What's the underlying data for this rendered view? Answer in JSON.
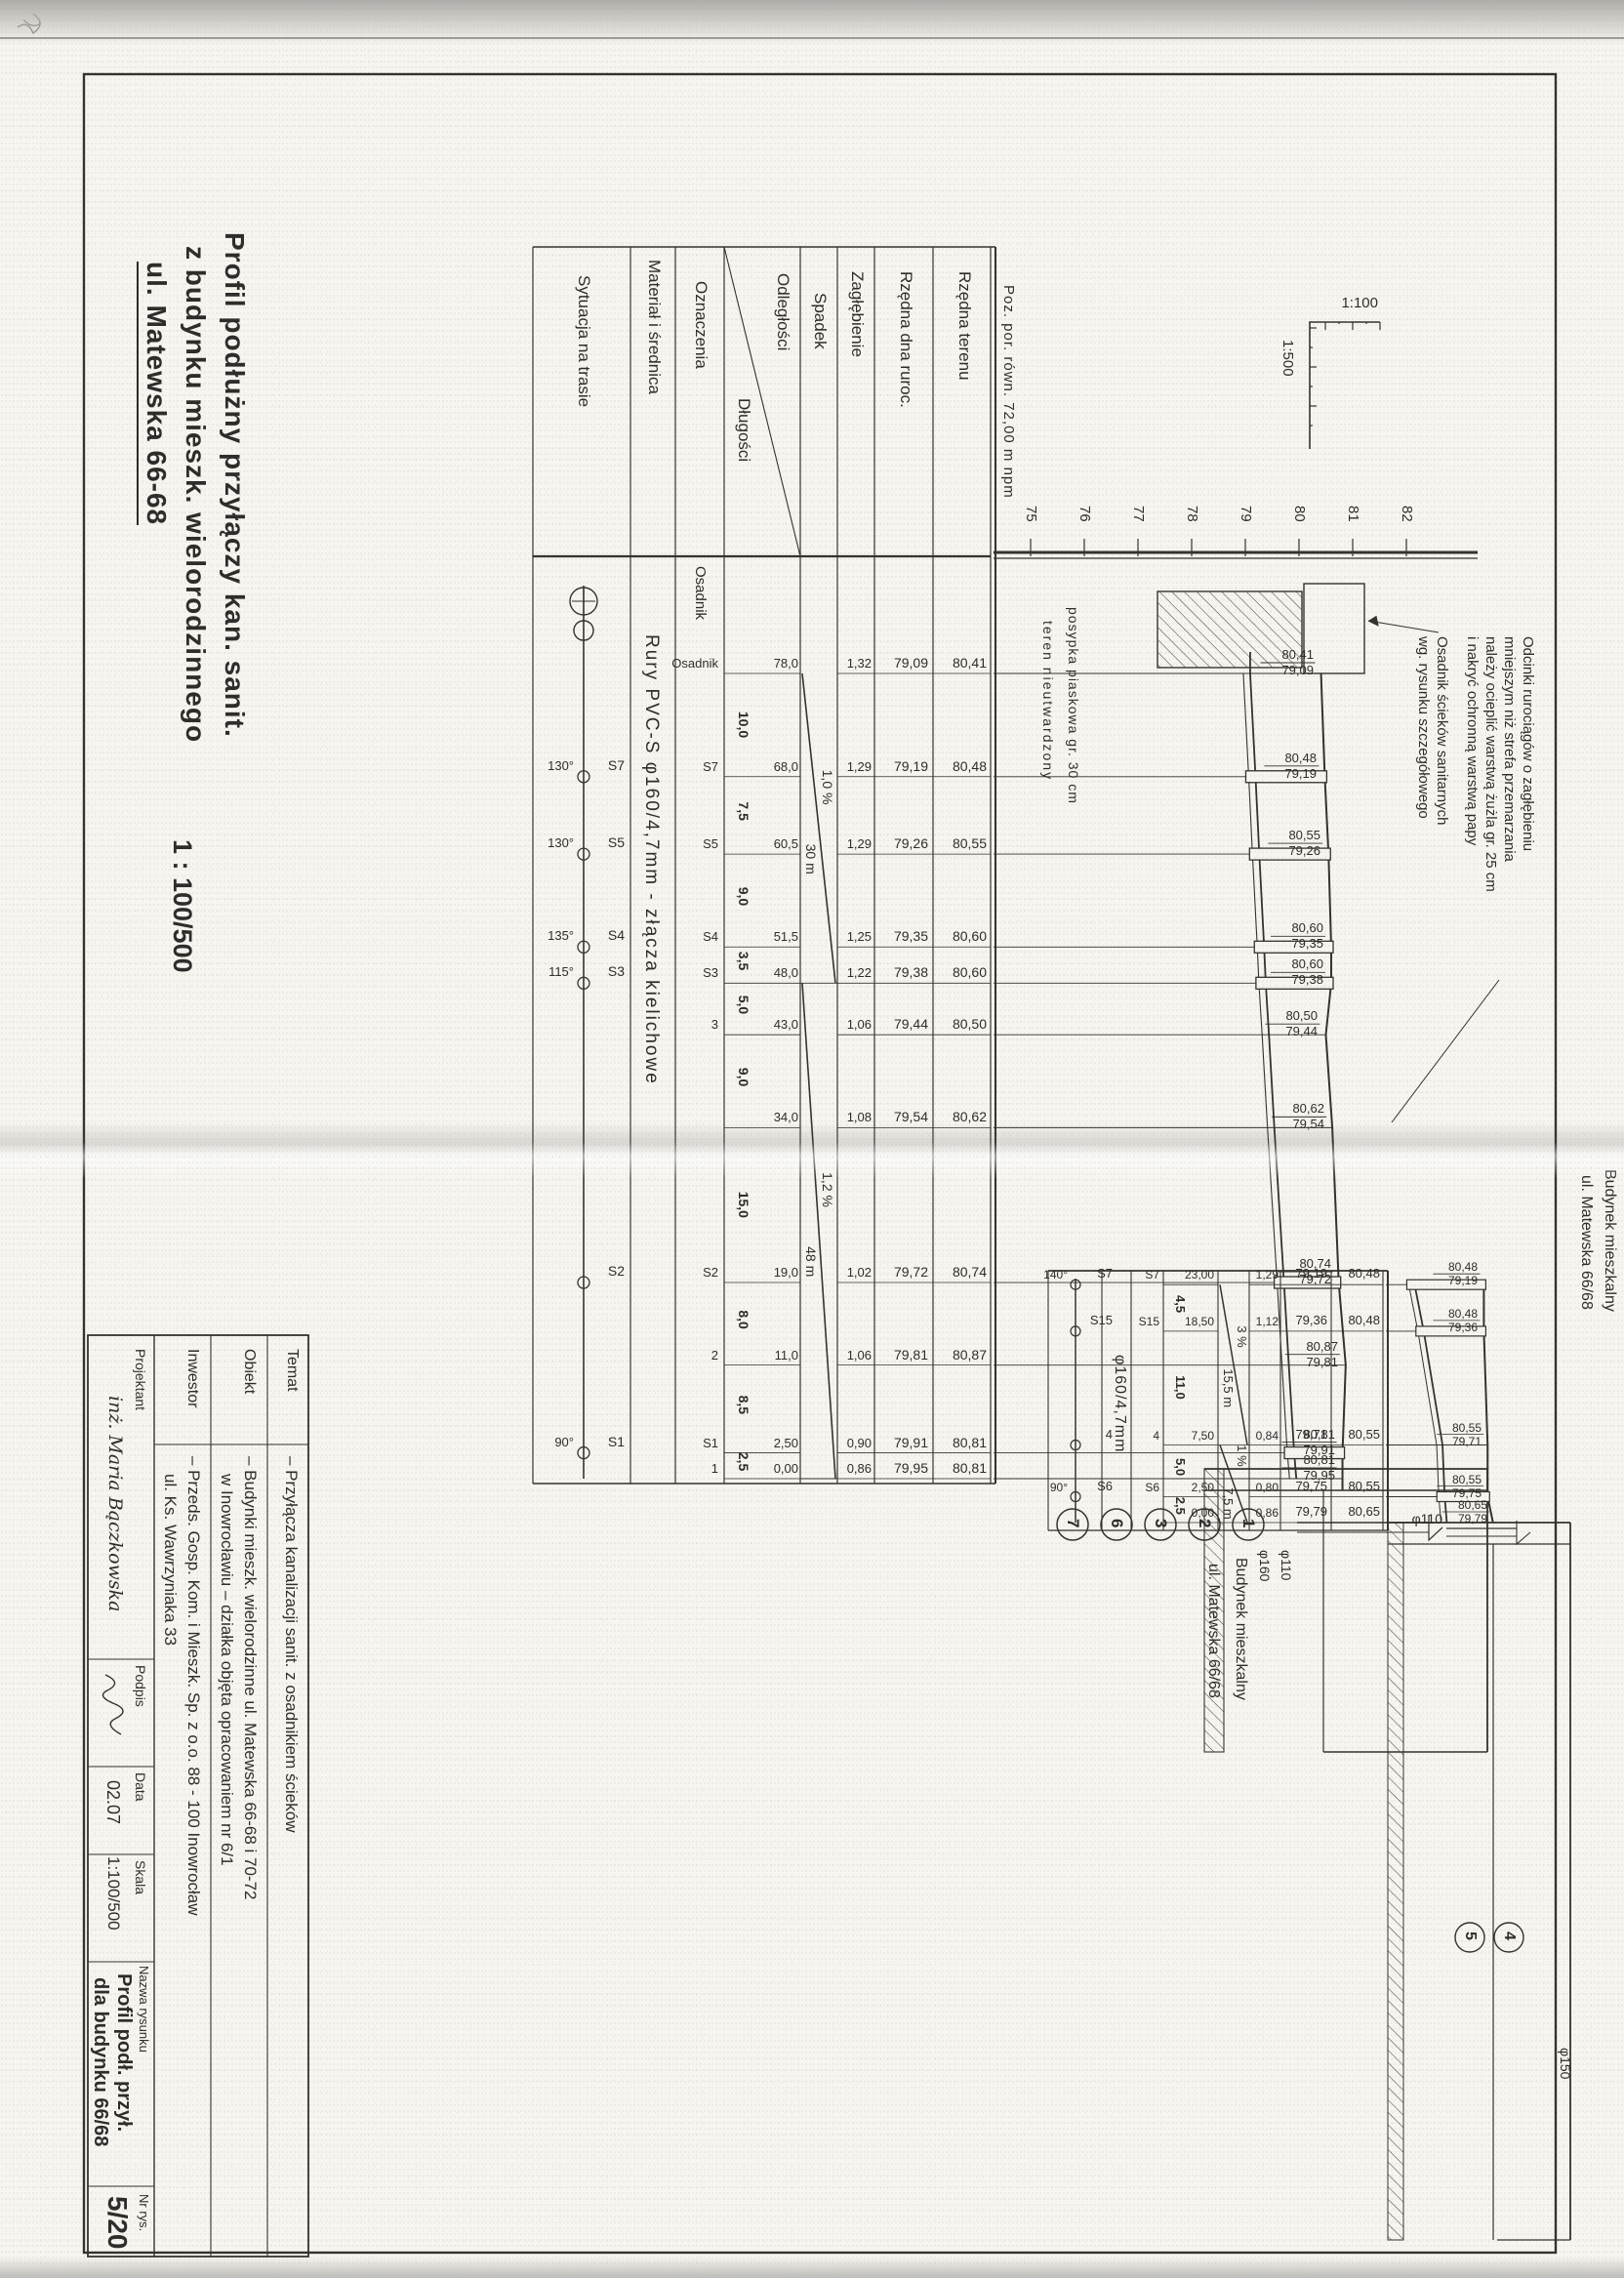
{
  "title": {
    "line1": "Profil podłużny przyłączy kan. sanit.",
    "line2": "z budynku mieszk. wielorodzinnego",
    "line3": "ul. Matewska 66-68",
    "scale": "1 : 100/500"
  },
  "scale_indicator": {
    "vertical": "1:100",
    "horizontal": "1:500"
  },
  "datum_label": "Poz. por. równ. 72,00 m npm",
  "axis_elevations": [
    "75",
    "76",
    "77",
    "78",
    "79",
    "80",
    "81",
    "82"
  ],
  "row_headers": {
    "rzedna_terenu": "Rzędna terenu",
    "rzedna_dna": "Rzędna dna ruroc.",
    "zaglebienie": "Zagłębienie",
    "spadek": "Spadek",
    "odleglosci": "Odległości",
    "dlugosci": "Długości",
    "oznaczenia": "Oznaczenia",
    "material": "Materiał i średnica",
    "sytuacja": "Sytuacja na trasie"
  },
  "notes": {
    "insulation": [
      "Odcinki rurociągów o zagłębieniu",
      "mniejszym niż strefa przemarzania",
      "należy ocieplić warstwą żużla gr. 25 cm",
      "i nakryć ochronną warstwą papy"
    ],
    "osadnik": [
      "Osadnik ścieków sanitarnych",
      "wg. rysunku szczegółowego"
    ]
  },
  "ground_notes": [
    "posypka piaskowa gr. 30 cm",
    "teren nieutwardzony"
  ],
  "upper": {
    "material": "Rury PVC-S  φ160/4,7mm - złącza kielichowe",
    "stations": [
      {
        "ch": "78,0",
        "chv": 78.0,
        "ter": "80,41",
        "terv": 80.41,
        "dna": "79,09",
        "dnav": 79.09,
        "zag": "1,32",
        "ozn": "Osadnik"
      },
      {
        "ch": "68,0",
        "chv": 68.0,
        "ter": "80,48",
        "terv": 80.48,
        "dna": "79,19",
        "dnav": 79.19,
        "zag": "1,29",
        "ozn": "S7"
      },
      {
        "ch": "60,5",
        "chv": 60.5,
        "ter": "80,55",
        "terv": 80.55,
        "dna": "79,26",
        "dnav": 79.26,
        "zag": "1,29",
        "ozn": "S5"
      },
      {
        "ch": "51,5",
        "chv": 51.5,
        "ter": "80,60",
        "terv": 80.6,
        "dna": "79,35",
        "dnav": 79.35,
        "zag": "1,25",
        "ozn": "S4"
      },
      {
        "ch": "48,0",
        "chv": 48.0,
        "ter": "80,60",
        "terv": 80.6,
        "dna": "79,38",
        "dnav": 79.38,
        "zag": "1,22",
        "ozn": "S3"
      },
      {
        "ch": "43,0",
        "chv": 43.0,
        "ter": "80,50",
        "terv": 80.5,
        "dna": "79,44",
        "dnav": 79.44,
        "zag": "1,06",
        "ozn": "3"
      },
      {
        "ch": "34,0",
        "chv": 34.0,
        "ter": "80,62",
        "terv": 80.62,
        "dna": "79,54",
        "dnav": 79.54,
        "zag": "1,08",
        "ozn": ""
      },
      {
        "ch": "19,0",
        "chv": 19.0,
        "ter": "80,74",
        "terv": 80.74,
        "dna": "79,72",
        "dnav": 79.72,
        "zag": "1,02",
        "ozn": "S2"
      },
      {
        "ch": "11,0",
        "chv": 11.0,
        "ter": "80,87",
        "terv": 80.87,
        "dna": "79,81",
        "dnav": 79.81,
        "zag": "1,06",
        "ozn": "2"
      },
      {
        "ch": "2,50",
        "chv": 2.5,
        "ter": "80,81",
        "terv": 80.81,
        "dna": "79,91",
        "dnav": 79.91,
        "zag": "0,90",
        "ozn": "S1"
      },
      {
        "ch": "0,00",
        "chv": 0.0,
        "ter": "80,81",
        "terv": 80.81,
        "dna": "79,95",
        "dnav": 79.95,
        "zag": "0,86",
        "ozn": "1"
      }
    ],
    "lengths": [
      "10,0",
      "7,5",
      "9,0",
      "3,5",
      "5,0",
      "9,0",
      "15,0",
      "8,0",
      "8,5",
      "2,5"
    ],
    "slopes": [
      {
        "label": "1,0 %",
        "length": "30 m",
        "from": 78.0,
        "to": 48.0
      },
      {
        "label": "1,2 %",
        "length": "48 m",
        "from": 48.0,
        "to": 0.0
      }
    ],
    "situation": [
      {
        "name": "S7",
        "angle": "130°",
        "chv": 68.0
      },
      {
        "name": "S5",
        "angle": "130°",
        "chv": 60.5
      },
      {
        "name": "S4",
        "angle": "135°",
        "chv": 51.5
      },
      {
        "name": "S3",
        "angle": "115°",
        "chv": 48.0
      },
      {
        "name": "S2",
        "angle": "",
        "chv": 19.0
      },
      {
        "name": "S1",
        "angle": "90°",
        "chv": 2.5
      }
    ],
    "building": {
      "line1": "Budynek mieszkalny",
      "line2": "ul. Matewska 66/68"
    },
    "callouts": [
      "1",
      "2",
      "3",
      "6",
      "7"
    ],
    "pipe_labels": [
      "φ110",
      "φ160"
    ]
  },
  "lower": {
    "material": "φ160/4,7mm",
    "stations": [
      {
        "ch": "23,00",
        "chv": 23.0,
        "ter": "80,48",
        "terv": 80.48,
        "dna": "79,19",
        "dnav": 79.19,
        "zag": "1,29",
        "ozn": "S7"
      },
      {
        "ch": "18,50",
        "chv": 18.5,
        "ter": "80,48",
        "terv": 80.48,
        "dna": "79,36",
        "dnav": 79.36,
        "zag": "1,12",
        "ozn": "S15"
      },
      {
        "ch": "7,50",
        "chv": 7.5,
        "ter": "80,55",
        "terv": 80.55,
        "dna": "79,71",
        "dnav": 79.71,
        "zag": "0,84",
        "ozn": "4"
      },
      {
        "ch": "2,50",
        "chv": 2.5,
        "ter": "80,55",
        "terv": 80.55,
        "dna": "79,75",
        "dnav": 79.75,
        "zag": "0,80",
        "ozn": "S6"
      },
      {
        "ch": "0,00",
        "chv": 0.0,
        "ter": "80,65",
        "terv": 80.65,
        "dna": "79,79",
        "dnav": 79.79,
        "zag": "0,86",
        "ozn": ""
      }
    ],
    "lengths": [
      "4,5",
      "11,0",
      "5,0",
      "2,5"
    ],
    "slopes": [
      {
        "label": "3 %",
        "length": "15,5 m",
        "from": 23.0,
        "to": 7.5
      },
      {
        "label": "1 %",
        "length": "7,5 m",
        "from": 7.5,
        "to": 0.0
      }
    ],
    "situation": [
      {
        "name": "S7",
        "angle": "140°",
        "chv": 23.0
      },
      {
        "name": "S15",
        "angle": "",
        "chv": 18.5
      },
      {
        "name": "4",
        "angle": "",
        "chv": 7.5
      },
      {
        "name": "S6",
        "angle": "90°",
        "chv": 2.5
      }
    ],
    "building": {
      "line1": "Budynek mieszkalny",
      "line2": "ul. Matewska 66/68"
    },
    "callouts": [
      "4",
      "5"
    ],
    "pipe_labels": [
      "φ110",
      "φ150"
    ]
  },
  "title_block": {
    "temat_label": "Temat",
    "temat": "– Przyłącza kanalizacji sanit. z osadnikiem ścieków",
    "obiekt_label": "Obiekt",
    "obiekt1": "– Budynki mieszk. wielorodzinne  ul. Matewska 66-68 i 70-72",
    "obiekt2": "w Inowrocławiu – działka objęta opracowaniem nr 6/1",
    "inwestor_label": "Inwestor",
    "inwestor1": "– Przeds. Gosp. Kom. i Mieszk. Sp. z o.o.   88 - 100  Inowrocław",
    "inwestor2": "ul. Ks. Wawrzyniaka 33",
    "projektant_label": "Projektant",
    "projektant": "inż. Maria Bączkowska",
    "podpis_label": "Podpis",
    "data_label": "Data",
    "data": "02.07",
    "skala_label": "Skala",
    "skala": "1:100/500",
    "nazwa_label": "Nazwa rysunku",
    "nazwa1": "Profil podł. przył.",
    "nazwa2": "dla budynku 66/68",
    "nr_label": "Nr rys.",
    "nr": "5/20"
  }
}
